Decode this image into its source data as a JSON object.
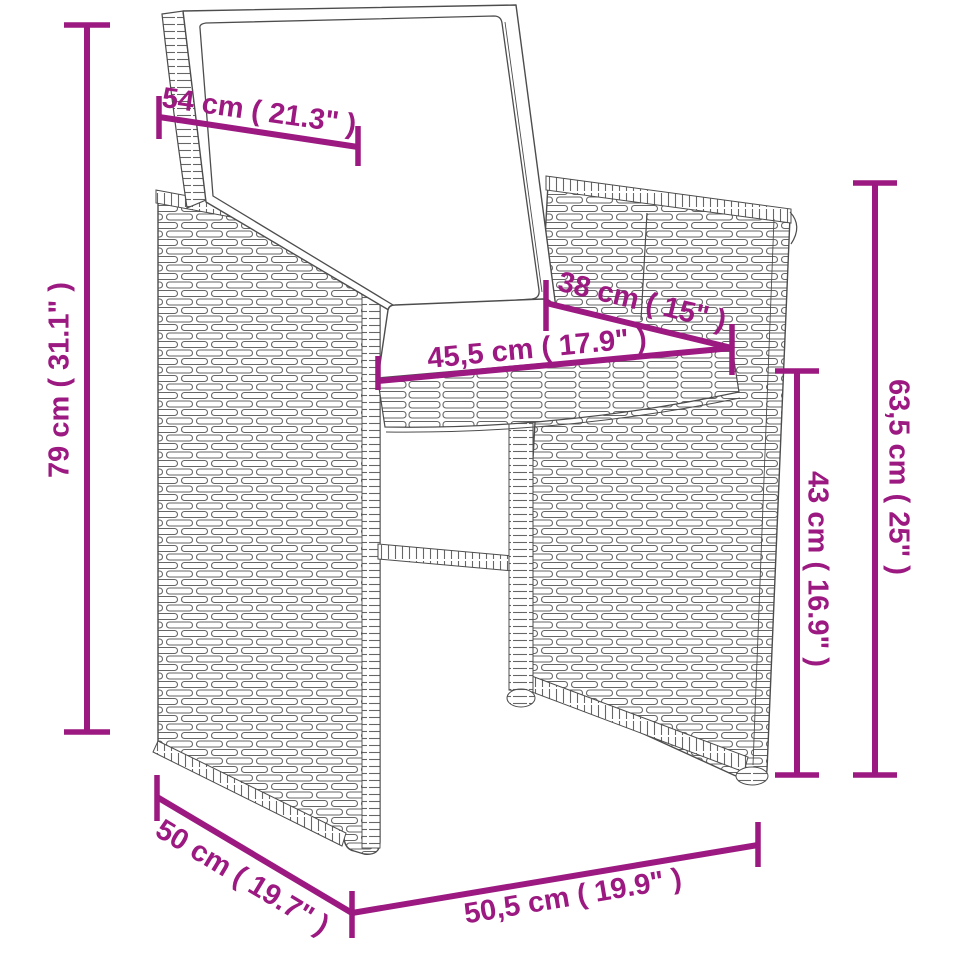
{
  "diagram": {
    "type": "product-dimension-diagram",
    "subject": "wicker-rattan-armchair-with-cushion",
    "accent_color": "#9B1980",
    "outline_color": "#4D4D4D",
    "dimensions": [
      {
        "id": "backrest-width",
        "label": "54 cm ( 21.3\" )"
      },
      {
        "id": "overall-height",
        "label": "79 cm ( 31.1\" )"
      },
      {
        "id": "seat-depth",
        "label": "38 cm ( 15\" )"
      },
      {
        "id": "seat-width",
        "label": "45,5 cm ( 17.9\" )"
      },
      {
        "id": "armrest-height",
        "label": "63,5 cm ( 25\" )"
      },
      {
        "id": "seat-height",
        "label": "43 cm ( 16.9\" )"
      },
      {
        "id": "base-depth",
        "label": "50 cm ( 19.7\" )"
      },
      {
        "id": "base-width",
        "label": "50,5 cm ( 19.9\" )"
      }
    ]
  }
}
